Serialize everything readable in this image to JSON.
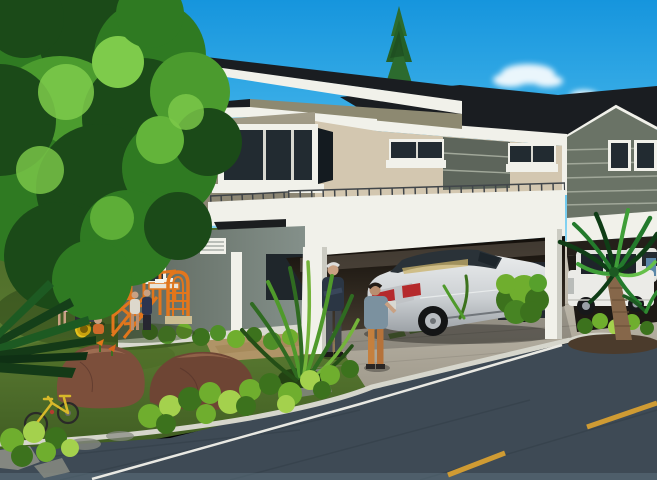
{
  "meta": {
    "type": "architectural rendering",
    "description": "3D architectural rendering of a modern two-storey duplex with dark mono-pitch and gable roofs, white carport beams and columns, a silver sedan parked in the driveway, a white SUV in the right carport, two men talking, a woman with children at an orange playground with a yellow tube slide, a large tree, a palm tree, boulders, a yellow bicycle, and a street with a dashed yellow center line."
  },
  "palette": {
    "sky_top": "#1695dd",
    "sky_mid": "#44b5ea",
    "sky_low": "#9adcf2",
    "roof": "#1a1d21",
    "white": "#f1f1ea",
    "glass": "#222b31",
    "wall_side": "#97917d",
    "wall_front": "#d3c7b0",
    "wall_olive": "#8d8971",
    "wall_accent": "#5d655b",
    "wall_gable": "#6a7366",
    "stripe": "#b3b9aa",
    "ground_wall": "#77827a",
    "interior": "#191410",
    "lawn": "#5a7a31",
    "lawn_dark": "#3f5c22",
    "shrub": "#6fae2e",
    "shrub_light": "#a4d14d",
    "shrub_dark": "#3c721d",
    "tree_dark": "#1b4a18",
    "tree_mid": "#2f7a22",
    "tree_light": "#4b9b2e",
    "tree_hi": "#7ecb4b",
    "rock": "#7c4f3b",
    "rock_hi": "#a57457",
    "rock_gray": "#848780",
    "road": "#3e4a55",
    "curb": "#d6d6cc",
    "line_white": "#e9e9e3",
    "line_yellow": "#cf9b33",
    "driveway": "#bcb7aa",
    "gravel": "#b09467",
    "slide": "#e5c11d",
    "play_orange": "#e2761c",
    "car_body": "#d7dadd",
    "car_shade": "#aeb2b6",
    "tail_red": "#b52a2c",
    "suv": "#ebebe7",
    "skin": "#c9a183",
    "shirt_navy": "#2b3644",
    "shirt_blue": "#7b919f",
    "pants_orange": "#c5803e",
    "top_red": "#a8323a",
    "palm_trunk": "#86674a"
  },
  "scene": {
    "building": {
      "units": 2,
      "storeys": 2,
      "roof_style": "dark skillion and gable",
      "features": [
        "white fascia",
        "balcony parapet with thin railing",
        "carport",
        "striped gray accent walls",
        "corner bay window",
        "louver vent"
      ]
    },
    "vehicles": [
      "silver sedan under left carport",
      "white SUV under right carport",
      "white car partly hidden behind palm"
    ],
    "people": [
      "elderly man in navy shirt",
      "young man in blue shirt and orange trousers",
      "woman in red top holding a child",
      "girl in pink dress",
      "boy in blue",
      "girl on ramp",
      "toddler at slide exit"
    ],
    "playground": [
      "orange climbing frame",
      "yellow tube slide",
      "orange arch ladder",
      "small kids table"
    ],
    "landscape": [
      "large leafy tree",
      "slender conifer",
      "palm tree in curbed island",
      "foreground palm fronds",
      "shrub rows",
      "two brown boulders",
      "gray stones",
      "yellow bicycle",
      "spiky ornamental plant",
      "gravel path"
    ],
    "road": {
      "markings": [
        "dashed yellow center line",
        "white edge line",
        "white curb band"
      ],
      "dash_count": 2
    }
  }
}
